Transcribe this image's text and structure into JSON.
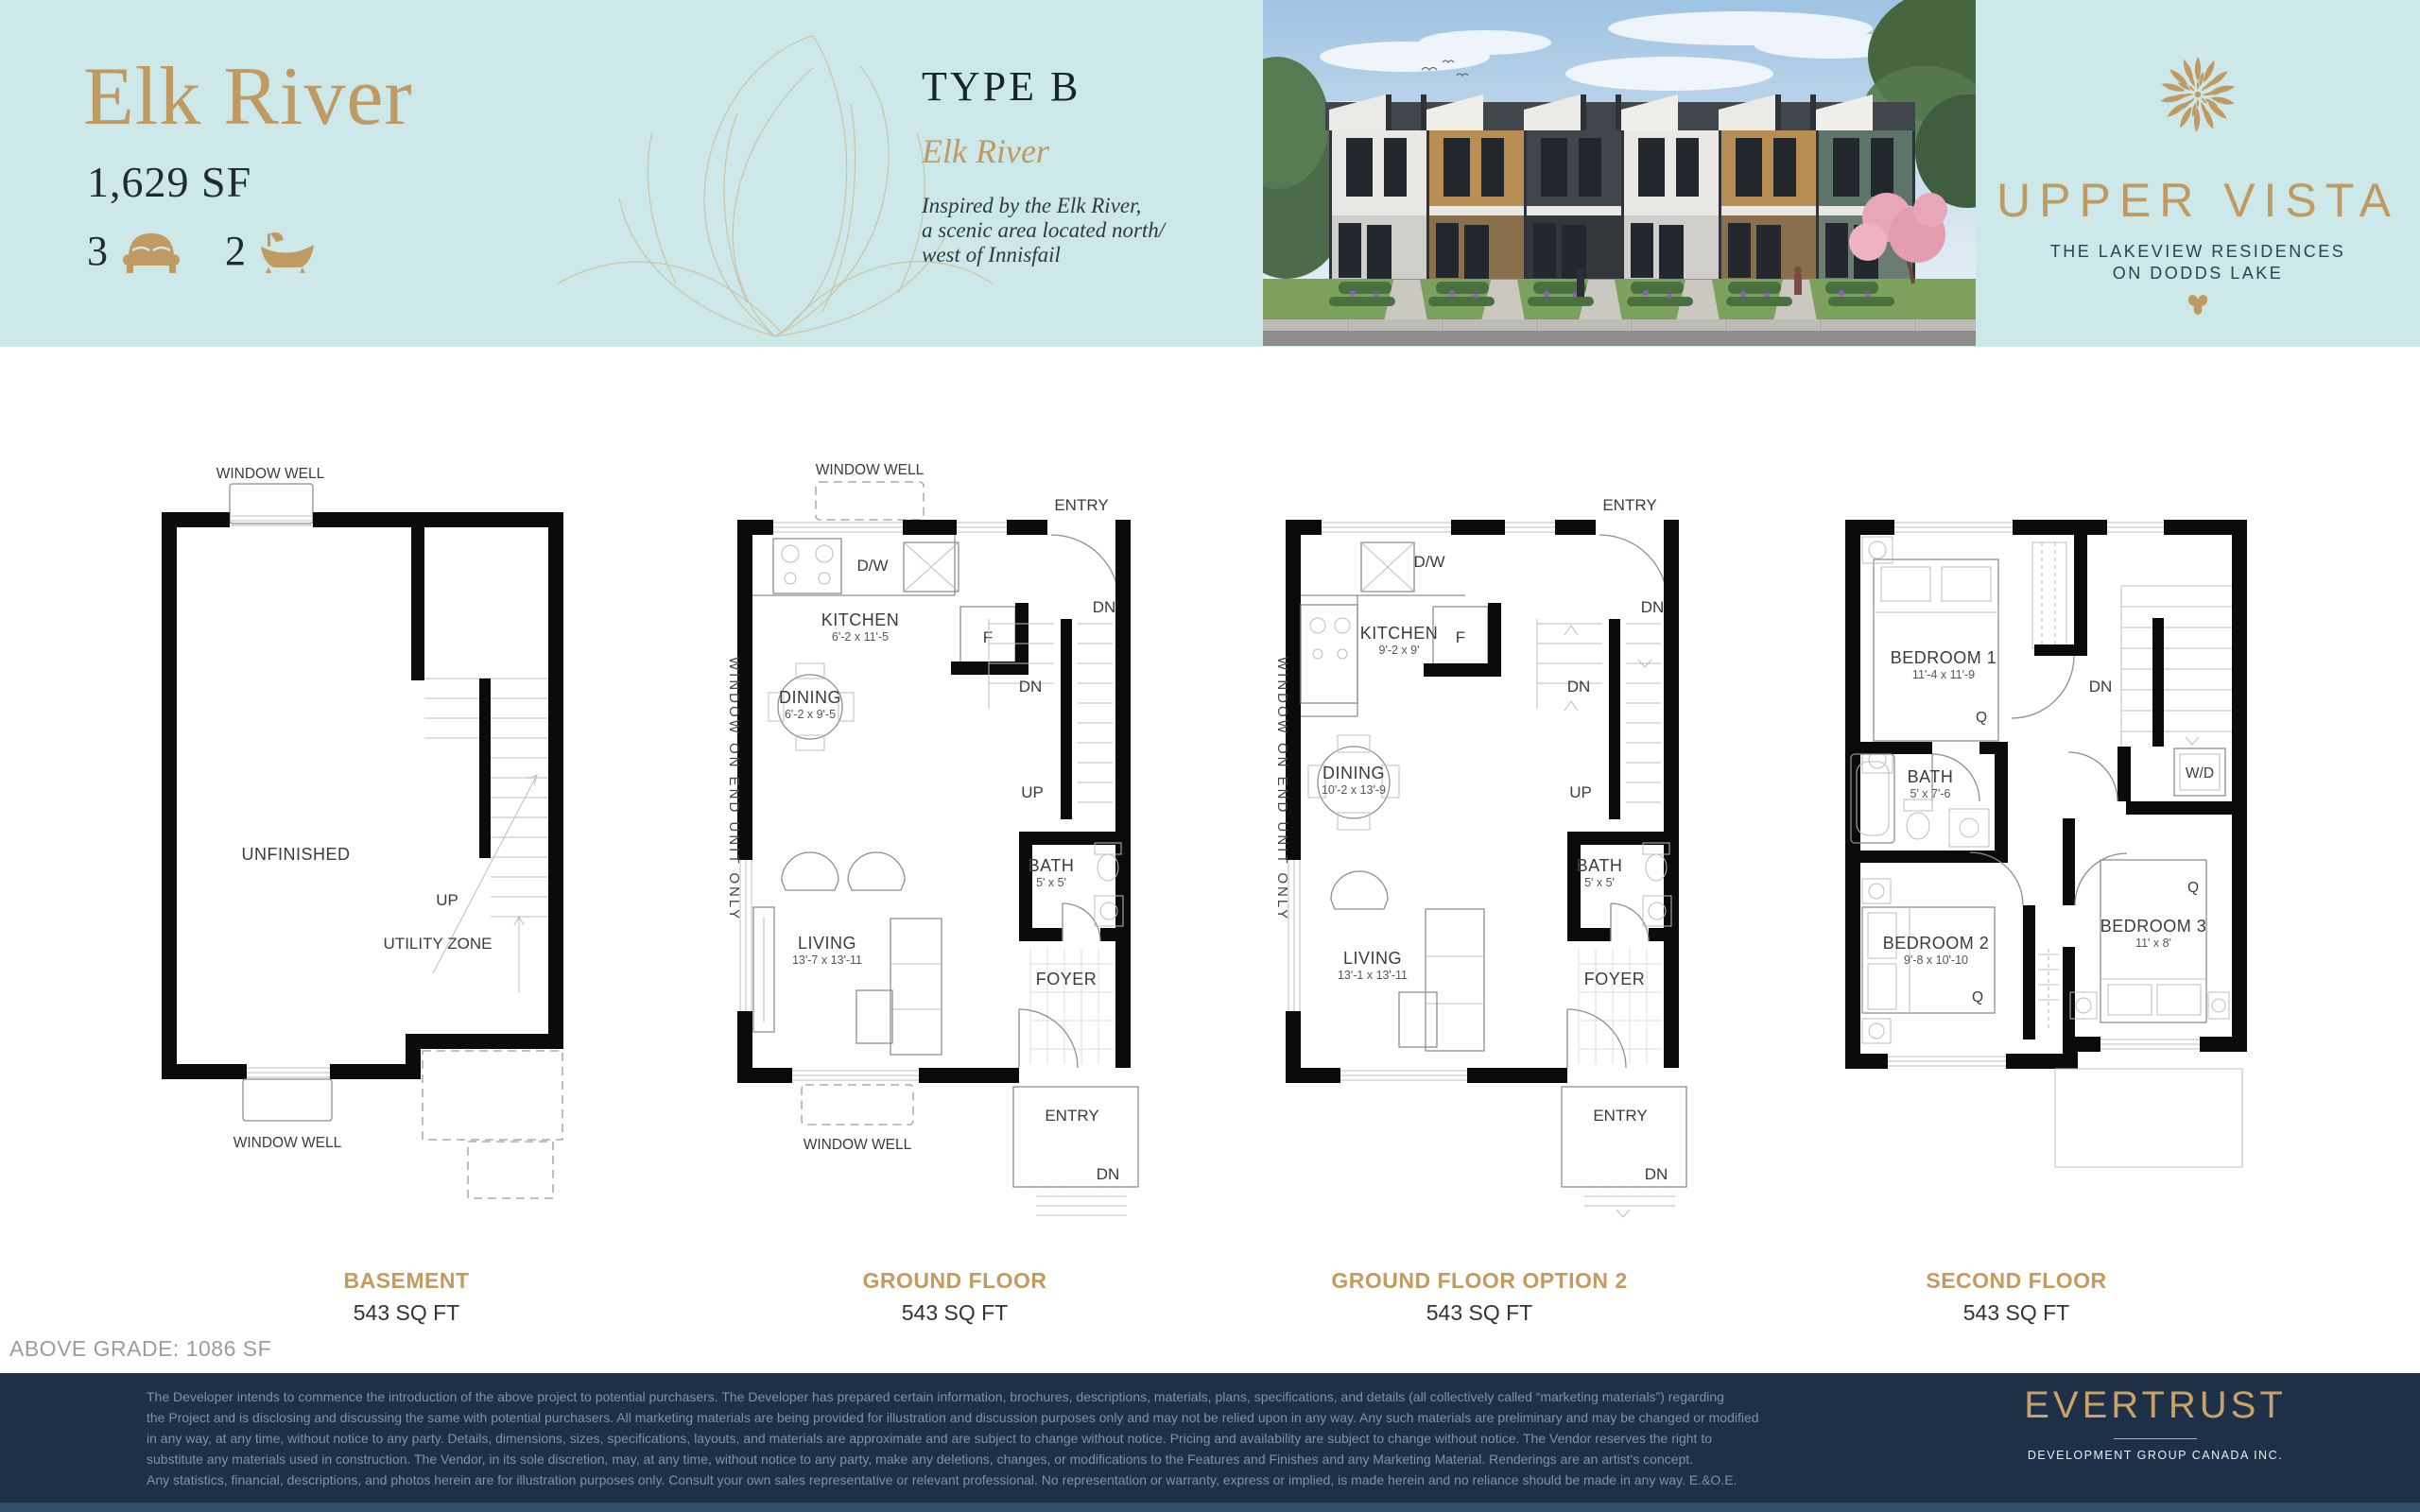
{
  "header": {
    "unit_name": "Elk River",
    "unit_area": "1,629 SF",
    "bed_count": "3",
    "bath_count": "2",
    "type_label": "TYPE B",
    "type_subtitle": "Elk River",
    "type_desc_line1": "Inspired by the Elk River,",
    "type_desc_line2": "a scenic area located north/",
    "type_desc_line3": "west of Innisfail",
    "brand_name": "UPPER VISTA",
    "brand_tagline_1": "THE LAKEVIEW RESIDENCES",
    "brand_tagline_2": "ON DODDS LAKE"
  },
  "colors": {
    "band_teal": "#cde8e8",
    "accent_gold": "#bf9a62",
    "footer_navy": "#1d3047",
    "caption_gold": "#c49a5e"
  },
  "plans": [
    {
      "caption": "BASEMENT",
      "sqft": "543 SQ FT",
      "labels": {
        "window_well_top": "WINDOW WELL",
        "window_well_bottom": "WINDOW WELL",
        "unfinished": "UNFINISHED",
        "utility_zone": "UTILITY ZONE",
        "up": "UP"
      }
    },
    {
      "caption": "GROUND FLOOR",
      "sqft": "543 SQ FT",
      "labels": {
        "window_well_top": "WINDOW WELL",
        "window_well_bottom": "WINDOW WELL",
        "entry_top": "ENTRY",
        "entry_bottom": "ENTRY",
        "dn_top": "DN",
        "dn_mid": "DN",
        "dn_bottom": "DN",
        "up": "UP",
        "dw": "D/W",
        "fridge": "F",
        "kitchen": "KITCHEN",
        "kitchen_dim": "6'-2 x 11'-5",
        "dining": "DINING",
        "dining_dim": "6'-2 x 9'-5",
        "living": "LIVING",
        "living_dim": "13'-7 x 13'-11",
        "bath": "BATH",
        "bath_dim": "5' x 5'",
        "foyer": "FOYER",
        "window_note": "WINDOW ON END UNIT ONLY"
      }
    },
    {
      "caption": "GROUND FLOOR OPTION 2",
      "sqft": "543 SQ FT",
      "labels": {
        "entry_top": "ENTRY",
        "entry_bottom": "ENTRY",
        "dn_top": "DN",
        "dn_mid": "DN",
        "dn_bottom": "DN",
        "up": "UP",
        "dw": "D/W",
        "fridge": "F",
        "kitchen": "KITCHEN",
        "kitchen_dim": "9'-2 x 9'",
        "dining": "DINING",
        "dining_dim": "10'-2 x 13'-9",
        "living": "LIVING",
        "living_dim": "13'-1 x 13'-11",
        "bath": "BATH",
        "bath_dim": "5' x 5'",
        "foyer": "FOYER",
        "window_note": "WINDOW ON END UNIT ONLY"
      }
    },
    {
      "caption": "SECOND FLOOR",
      "sqft": "543 SQ FT",
      "labels": {
        "bedroom1": "BEDROOM 1",
        "bedroom1_dim": "11'-4 x 11'-9",
        "bedroom2": "BEDROOM 2",
        "bedroom2_dim": "9'-8 x 10'-10",
        "bedroom3": "BEDROOM 3",
        "bedroom3_dim": "11' x 8'",
        "bath": "BATH",
        "bath_dim": "5' x 7'-6",
        "wd": "W/D",
        "dn": "DN",
        "q1": "Q",
        "q2": "Q",
        "q3": "Q"
      }
    }
  ],
  "above_grade": "ABOVE GRADE: 1086 SF",
  "footer": {
    "disclaimer_lines": [
      "The Developer intends to commence the introduction of the above project to potential purchasers. The Developer has prepared certain information, brochures, descriptions, materials, plans, specifications, and details (all collectively called “marketing materials”) regarding",
      "the Project and is disclosing and discussing the same with potential purchasers. All marketing materials are being provided for illustration and discussion purposes only and may not be relied upon in any way. Any such materials are preliminary and may be changed or modified",
      "in any way, at any time, without notice to any party. Details, dimensions, sizes, specifications, layouts, and materials are approximate and are subject to change without notice. Pricing and availability are subject to change without notice. The Vendor reserves the right to",
      "substitute any materials used in construction. The Vendor, in its sole discretion, may, at any time, without notice to any party, make any deletions, changes, or modifications to the Features and Finishes and any Marketing Material. Renderings are an artist's concept.",
      "Any statistics, financial, descriptions, and photos herein are for illustration purposes only. Consult your own sales representative or relevant professional. No representation or warranty, express or implied, is made herein and no reliance should be made in any way. E.&O.E."
    ],
    "logo_name": "EVERTRUST",
    "logo_sub": "DEVELOPMENT GROUP CANADA INC."
  }
}
